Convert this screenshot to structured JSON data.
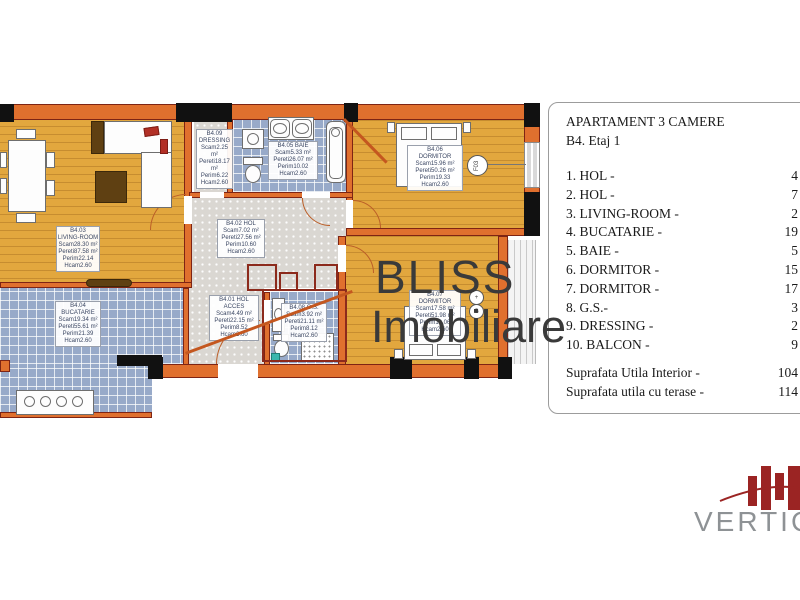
{
  "panel": {
    "title": "APARTAMENT 3 CAMERE",
    "subtitle": "B4. Etaj 1",
    "items": [
      {
        "label": "1. HOL -",
        "value": "4"
      },
      {
        "label": "2. HOL -",
        "value": "7"
      },
      {
        "label": "3. LIVING-ROOM -",
        "value": "2"
      },
      {
        "label": "4. BUCATARIE -",
        "value": "19"
      },
      {
        "label": "5. BAIE -",
        "value": "5"
      },
      {
        "label": "6. DORMITOR -",
        "value": "15"
      },
      {
        "label": "7. DORMITOR -",
        "value": "17"
      },
      {
        "label": "8. G.S.-",
        "value": "3"
      },
      {
        "label": "9. DRESSING -",
        "value": "2"
      },
      {
        "label": "10. BALCON -",
        "value": "9"
      }
    ],
    "totals": [
      {
        "label": "Suprafata Utila Interior -",
        "value": "104"
      },
      {
        "label": "Suprafata utila cu terase -",
        "value": "114"
      }
    ]
  },
  "watermark": {
    "line1": "BLISS",
    "line2": "Imobiliare"
  },
  "brand": {
    "name": "VERTICA",
    "bar_color": "#9b2423",
    "text_color": "#8e9295"
  },
  "plan": {
    "window_tag": "F03",
    "marker1": "+",
    "marker2": "G",
    "rooms": [
      {
        "id": "b4-03",
        "x": 56,
        "y": 226,
        "w": 44,
        "lines": [
          "B4.03",
          "LIVING-ROOM",
          "Scam28.30 m²",
          "Pereti87.58 m²",
          "Perim22.14",
          "Hcam2.60"
        ]
      },
      {
        "id": "b4-04",
        "x": 55,
        "y": 301,
        "w": 46,
        "lines": [
          "B4.04",
          "BUCATARIE",
          "Scam19.34 m²",
          "Pereti55.61 m²",
          "Perim21.39",
          "Hcam2.60"
        ]
      },
      {
        "id": "b4-09",
        "x": 196,
        "y": 129,
        "w": 37,
        "lines": [
          "B4.09",
          "DRESSING",
          "Scam2.25 m²",
          "Pereti18.17 m²",
          "Perim6.22",
          "Hcam2.60"
        ]
      },
      {
        "id": "b4-05",
        "x": 268,
        "y": 141,
        "w": 50,
        "lines": [
          "B4.05 BAIE",
          "Scam5.33 m²",
          "Pereti26.07 m²",
          "Perim10.02",
          "Hcam2.60"
        ]
      },
      {
        "id": "b4-06",
        "x": 407,
        "y": 145,
        "w": 56,
        "lines": [
          "B4.06",
          "DORMITOR",
          "Scam15.96 m²",
          "Pereti50.26 m²",
          "Perim19.33",
          "Hcam2.60"
        ]
      },
      {
        "id": "b4-02",
        "x": 217,
        "y": 219,
        "w": 48,
        "lines": [
          "B4.02 HOL",
          "Scam7.02 m²",
          "Pereti27.56 m²",
          "Perim10.60",
          "Hcam2.60"
        ]
      },
      {
        "id": "b4-01",
        "x": 209,
        "y": 295,
        "w": 50,
        "lines": [
          "B4.01 HOL",
          "ACCES",
          "Scam4.49 m²",
          "Pereti22.15 m²",
          "Perim8.52",
          "Hcam2.60"
        ]
      },
      {
        "id": "b4-08",
        "x": 281,
        "y": 303,
        "w": 46,
        "lines": [
          "B4.08 G.S.",
          "Scam3.92 m²",
          "Pereti21.11 m²",
          "Perim8.12",
          "Hcam2.60"
        ]
      },
      {
        "id": "b4-07",
        "x": 409,
        "y": 290,
        "w": 52,
        "lines": [
          "B4.07",
          "DORMITOR",
          "Scam17.58 m²",
          "Pereti51.98 m²",
          "Perim19.06",
          "Hcam2.60"
        ]
      }
    ]
  },
  "colors": {
    "wall_orange": "#e0702e",
    "wall_outline": "#7e2414",
    "wood_floor": "#e2a73e",
    "tile_floor": "#98aac9",
    "gray_floor": "#dad7d2",
    "watermark_gray": "#3a3a3a",
    "watermark_red": "#8c2a1c",
    "brand_red": "#9b2423"
  }
}
